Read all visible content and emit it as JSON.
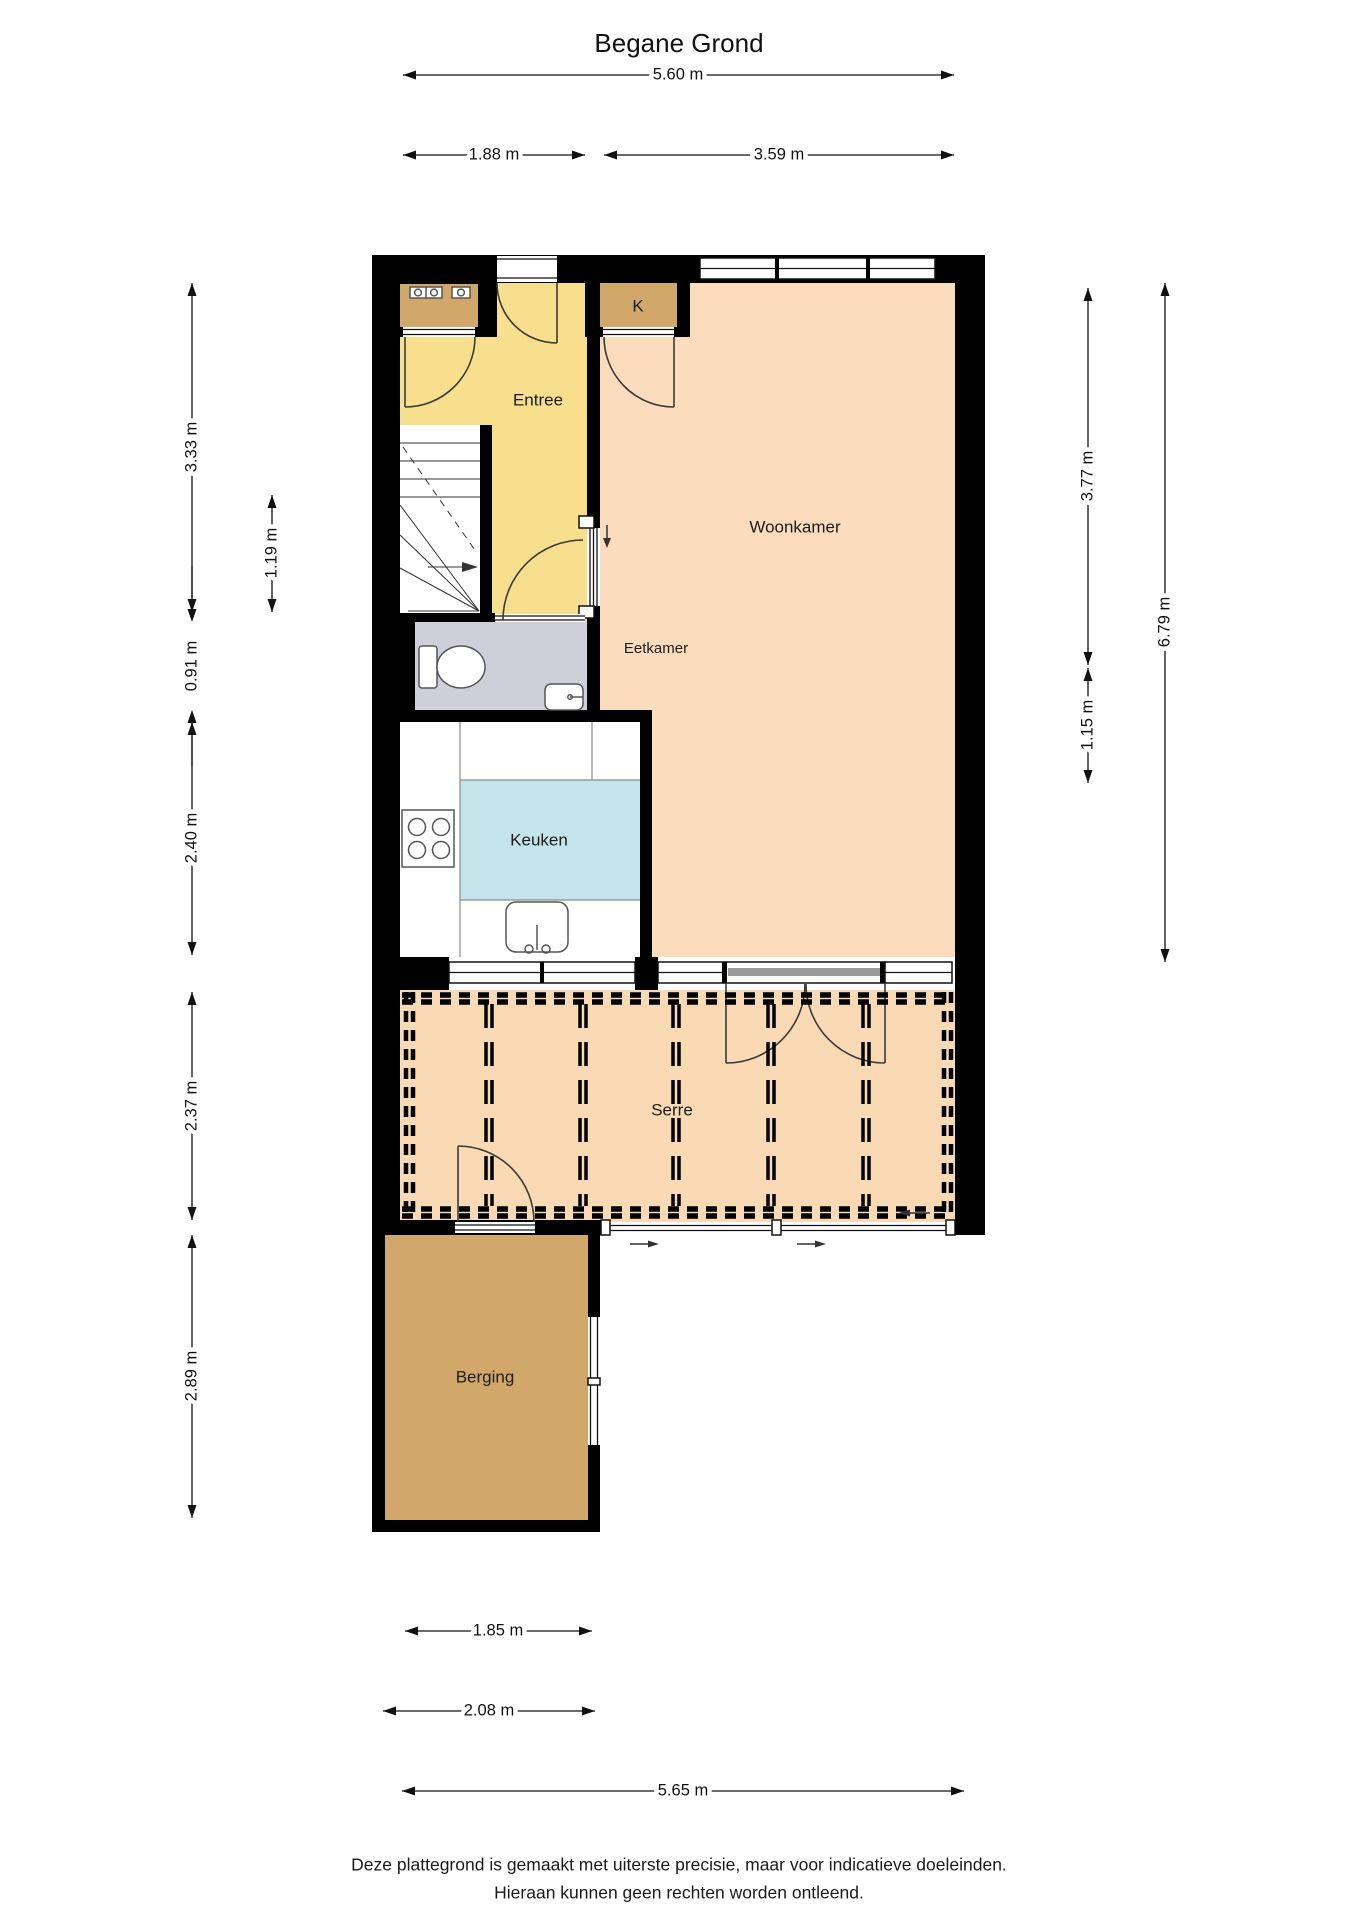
{
  "title": "Begane Grond",
  "rooms": {
    "entree": "Entree",
    "kast": "K",
    "woonkamer": "Woonkamer",
    "eetkamer": "Eetkamer",
    "keuken": "Keuken",
    "serre": "Serre",
    "berging": "Berging"
  },
  "dimensions": {
    "top_total": "5.60 m",
    "top_entree": "1.88 m",
    "top_woonkamer": "3.59 m",
    "left_entree": "3.33 m",
    "left_trap": "1.19 m",
    "left_toilet": "0.91 m",
    "left_keuken": "2.40 m",
    "left_serre": "2.37 m",
    "left_berging": "2.89 m",
    "right_woonkamer": "3.77 m",
    "right_eetkamer": "1.15 m",
    "right_total": "6.79 m",
    "bottom_berging_binnen": "1.85 m",
    "bottom_berging_buiten": "2.08 m",
    "bottom_total": "5.65 m"
  },
  "footer": {
    "line1": "Deze plattegrond is gemaakt met uiterste precisie, maar voor indicatieve doeleinden.",
    "line2": "Hieraan kunnen geen rechten worden ontleend."
  },
  "colors": {
    "wall": "#000000",
    "entree": "#f7df8d",
    "woonkamer": "#fbdcbc",
    "serre": "#fad9b5",
    "keuken_vloer": "#c2e4ea",
    "toilet": "#cfcfda",
    "kast": "#d2a76a",
    "berging": "#d2a76a"
  }
}
